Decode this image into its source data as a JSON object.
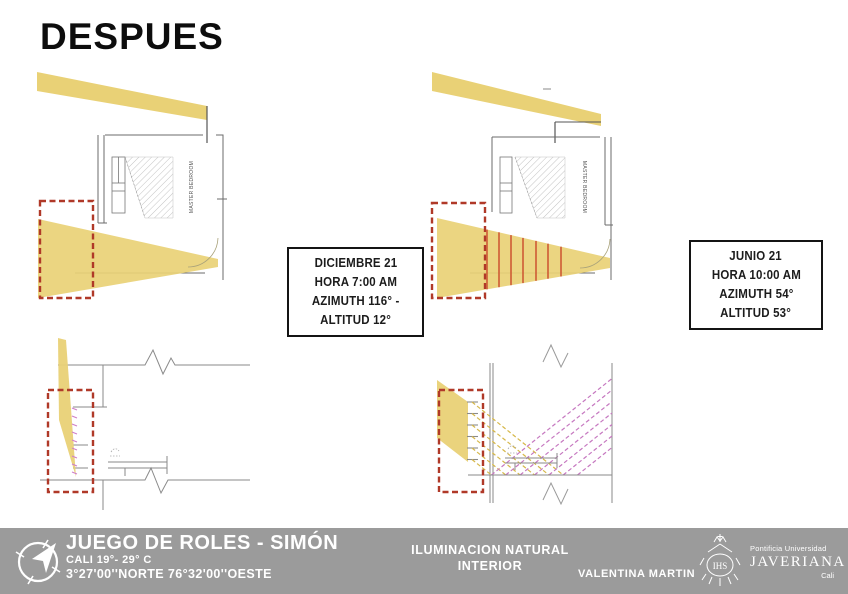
{
  "title": "DESPUES",
  "info_boxes": [
    {
      "lines": [
        "DICIEMBRE 21",
        "HORA 7:00 AM",
        "AZIMUTH 116° -",
        "ALTITUD 12°"
      ]
    },
    {
      "lines": [
        "JUNIO 21",
        "HORA 10:00 AM",
        "AZIMUTH 54°",
        "ALTITUD 53°"
      ]
    }
  ],
  "panels": {
    "plan_december": {
      "room_label": "MASTER BEDROOM"
    },
    "plan_june": {
      "room_label": "MASTER BEDROOM"
    }
  },
  "footer": {
    "project_title": "JUEGO DE ROLES - SIMÓN",
    "climate": "CALI 19°- 29° C",
    "coordinates": "3°27'00''NORTE 76°32'00''OESTE",
    "course_line1": "ILUMINACION NATURAL",
    "course_line2": "INTERIOR",
    "author": "VALENTINA MARTIN",
    "university_pre": "Pontificia Universidad",
    "university_name": "JAVERIANA",
    "university_city": "Cali",
    "crest_monogram": "IHS"
  },
  "colors": {
    "beam_yellow": "#e9d176",
    "window_marker_red": "#b03928",
    "louver_red": "#cf5b35",
    "reflected_ray_magenta": "#c678c0",
    "footer_gray": "#9b9b9b"
  }
}
